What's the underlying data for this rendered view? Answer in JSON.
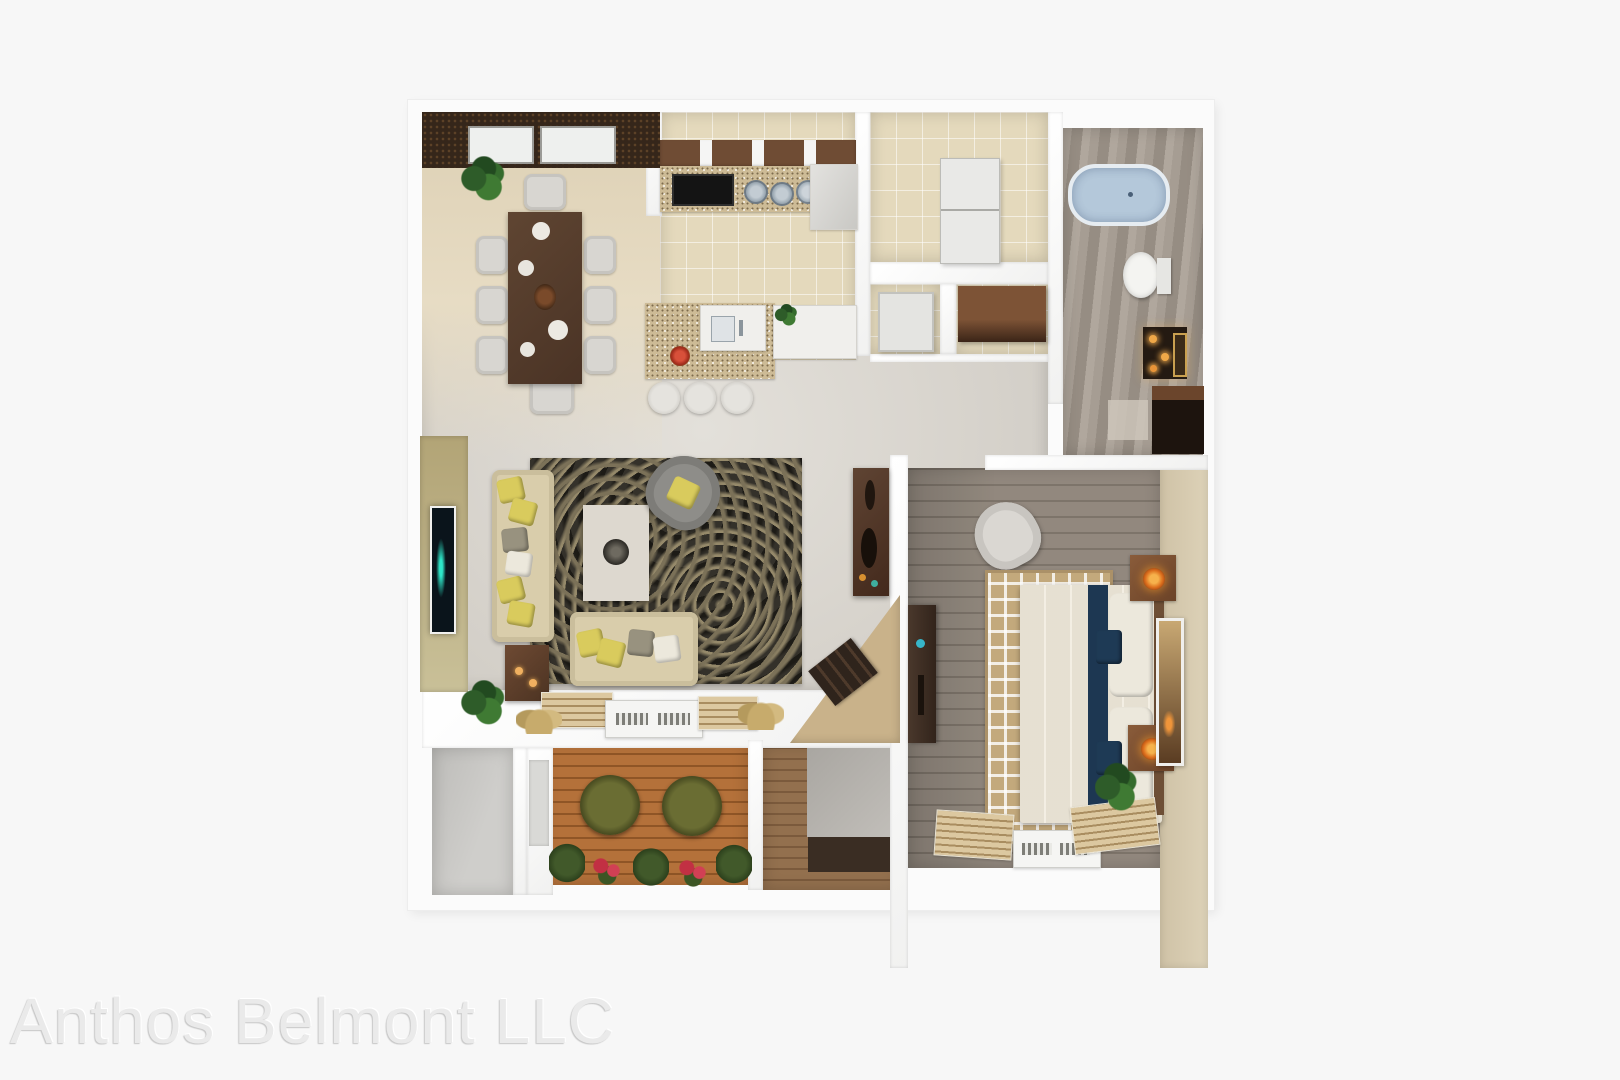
{
  "watermark": {
    "text": "Anthos Belmont LLC"
  },
  "scene": {
    "type": "3d-floor-plan-rendering",
    "view": "top-down",
    "rooms": [
      {
        "name": "dining-room",
        "furnishings": [
          "dark-wood-dining-table",
          "eight-white-chairs",
          "corner-plant",
          "dark-accent-wall-with-two-windows"
        ]
      },
      {
        "name": "kitchen",
        "furnishings": [
          "cooktop",
          "granite-counter",
          "round-sinks",
          "corner-cabinet",
          "granite-island-with-sink",
          "fruit-bowl",
          "three-stools"
        ]
      },
      {
        "name": "laundry-room",
        "furnishings": [
          "stacked-washer-dryer"
        ]
      },
      {
        "name": "closet",
        "furnishings": [
          "white-door-panel",
          "brown-wall-cabinet"
        ]
      },
      {
        "name": "bathroom",
        "furnishings": [
          "bathtub",
          "toilet",
          "vanity-with-candles",
          "dark-linen-closet"
        ]
      },
      {
        "name": "living-room",
        "furnishings": [
          "wall-tv",
          "cream-sofa",
          "cream-loveseat",
          "gray-armchair",
          "white-coffee-table",
          "dark-mottled-rug",
          "side-table",
          "console-table",
          "corner-desk-with-books",
          "floor-plant"
        ]
      },
      {
        "name": "bedroom",
        "furnishings": [
          "bed-with-navy-runner",
          "maze-pattern-rug",
          "white-armchair",
          "dresser",
          "two-nightstands-with-orange-lamps",
          "leaning-mirror",
          "window-blinds",
          "ac-unit",
          "corner-plant"
        ]
      },
      {
        "name": "patio",
        "furnishings": [
          "wood-deck",
          "two-round-chairs",
          "planter-bushes",
          "red-flowers"
        ]
      },
      {
        "name": "storage-room",
        "furnishings": []
      },
      {
        "name": "entry",
        "furnishings": [
          "wood-step",
          "dark-mat"
        ]
      }
    ]
  },
  "palette": {
    "background": "#f7f7f7",
    "wall_white": "#fbfbfb",
    "dining_floor": "#ddd0b4",
    "kitchen_tile": "#e4d9bc",
    "living_floor": "#d7d3cc",
    "bedroom_floor": "#8b8176",
    "bathroom_floor": "#9d948a",
    "patio_deck": "#b0703c",
    "accent_wall_dark": "#35261a",
    "accent_wall_olive": "#b2a476",
    "accent_wall_beige": "#d3c7ae",
    "bathtub_blue": "#b4c8da",
    "sofa_cream": "#d9cdab",
    "pillow_yellow": "#d9cb5d",
    "bed_navy": "#1d3752",
    "rug_dark": "#34312a",
    "rug_maze_tan": "#c3a97c",
    "lamp_orange": "#dd6f1d"
  }
}
